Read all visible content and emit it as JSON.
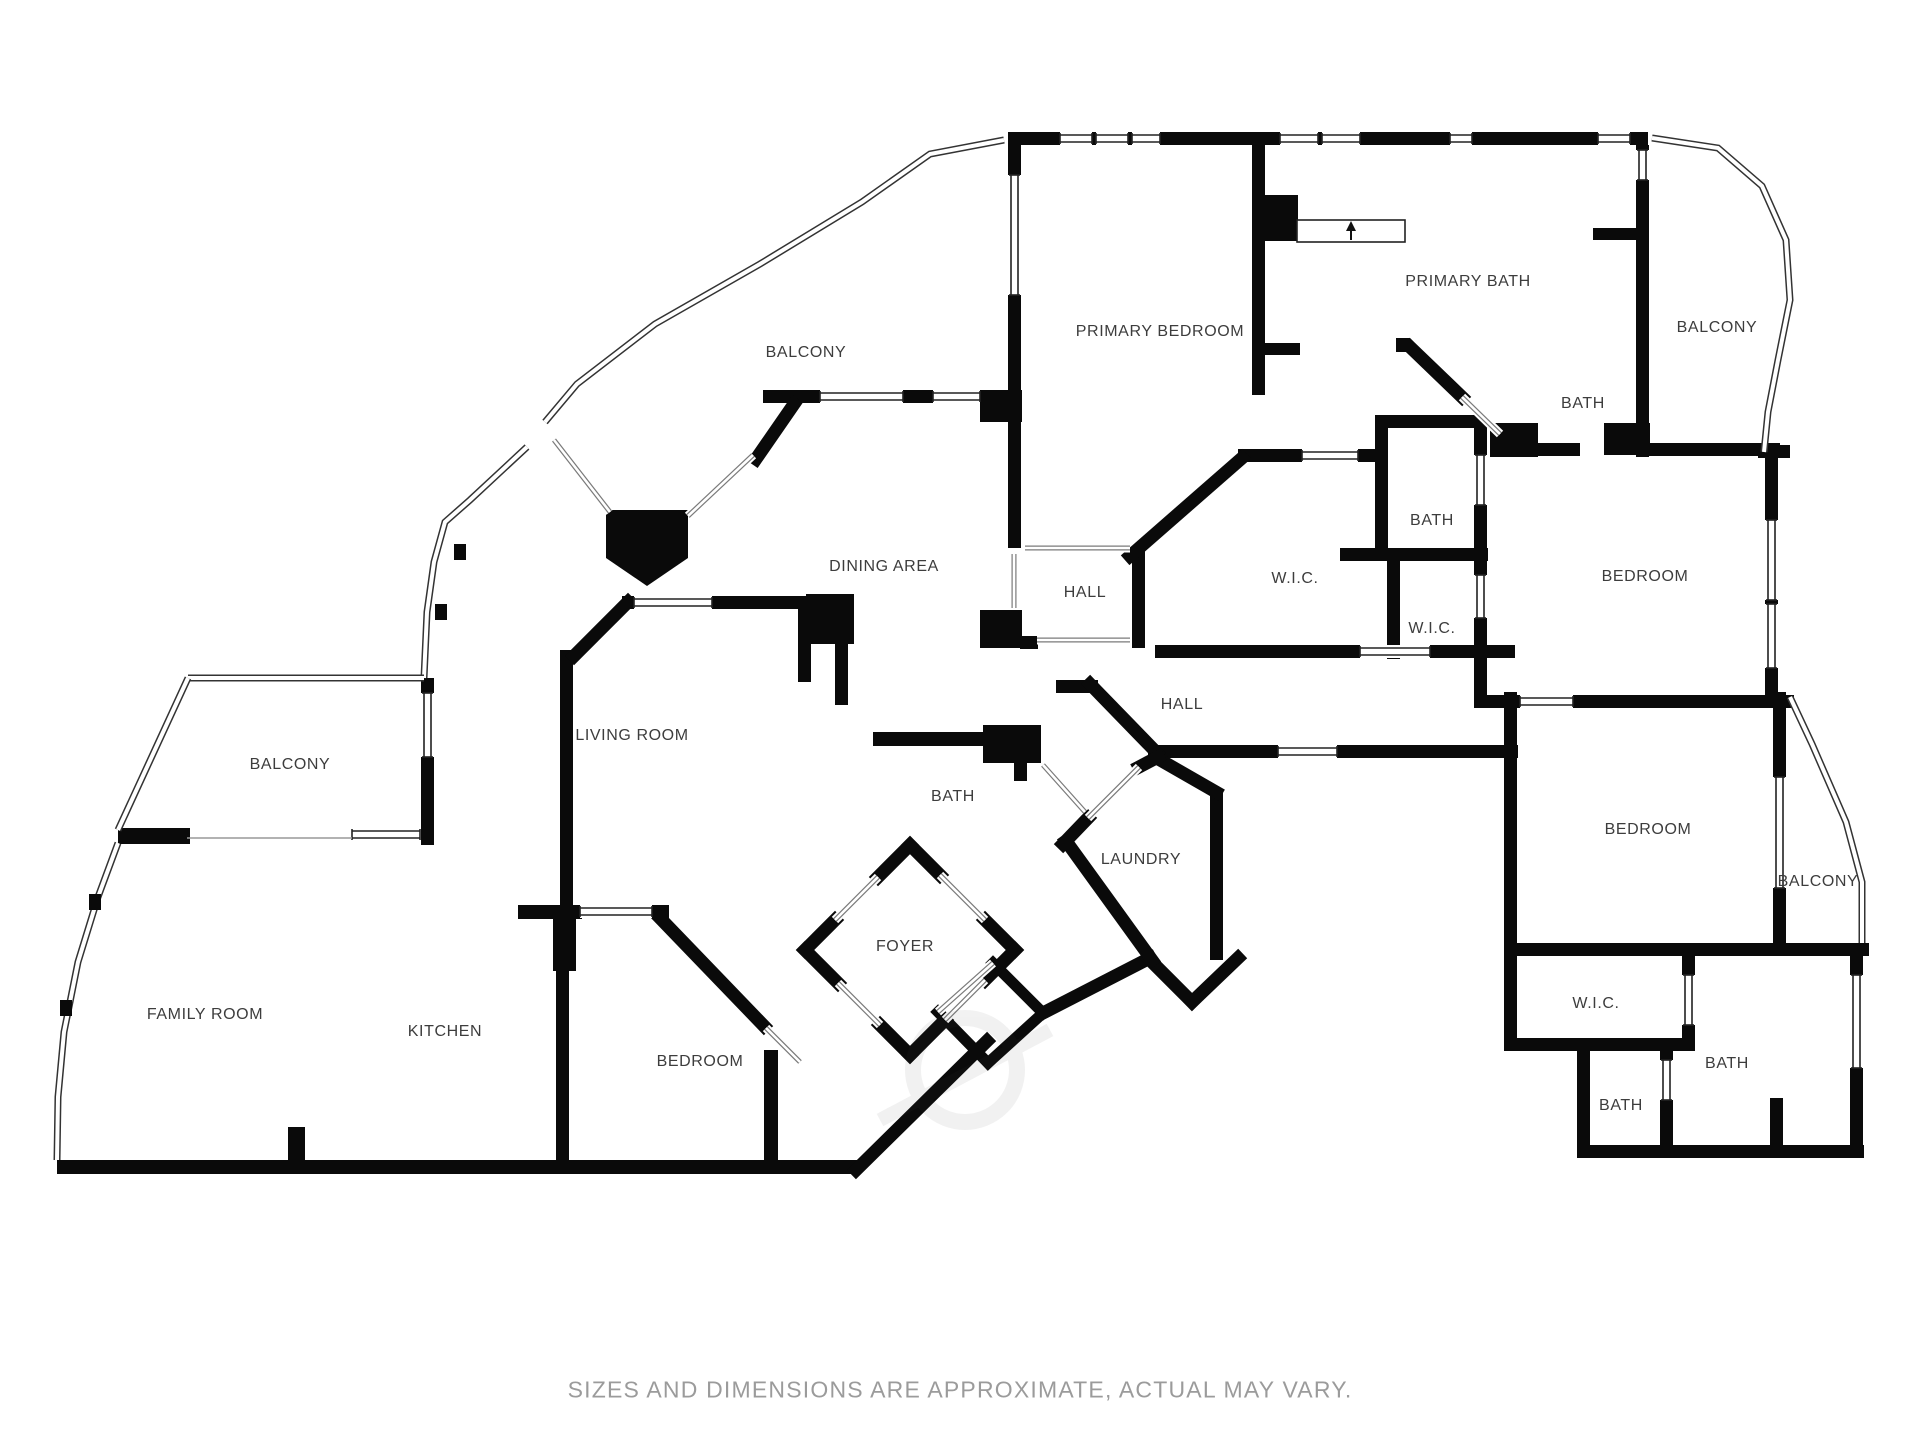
{
  "plan": {
    "wall_color": "#0a0a0a",
    "label_color": "#3d3d3d",
    "rooms": [
      {
        "slug": "balcony-top",
        "label": "BALCONY",
        "x": 806,
        "y": 353
      },
      {
        "slug": "primary-bedroom",
        "label": "PRIMARY BEDROOM",
        "x": 1160,
        "y": 332
      },
      {
        "slug": "primary-bath",
        "label": "PRIMARY BATH",
        "x": 1468,
        "y": 282
      },
      {
        "slug": "balcony-top-right",
        "label": "BALCONY",
        "x": 1717,
        "y": 328
      },
      {
        "slug": "bath-top-right",
        "label": "BATH",
        "x": 1583,
        "y": 404
      },
      {
        "slug": "bath-mid",
        "label": "BATH",
        "x": 1432,
        "y": 521
      },
      {
        "slug": "wic-main",
        "label": "W.I.C.",
        "x": 1295,
        "y": 579
      },
      {
        "slug": "wic-small",
        "label": "W.I.C.",
        "x": 1432,
        "y": 629
      },
      {
        "slug": "bedroom-right",
        "label": "BEDROOM",
        "x": 1645,
        "y": 577
      },
      {
        "slug": "hall-upper",
        "label": "HALL",
        "x": 1085,
        "y": 593
      },
      {
        "slug": "dining-area",
        "label": "DINING AREA",
        "x": 884,
        "y": 567
      },
      {
        "slug": "hall-lower",
        "label": "HALL",
        "x": 1182,
        "y": 705
      },
      {
        "slug": "living-room",
        "label": "LIVING ROOM",
        "x": 632,
        "y": 736
      },
      {
        "slug": "balcony-left",
        "label": "BALCONY",
        "x": 290,
        "y": 765
      },
      {
        "slug": "bath-center",
        "label": "BATH",
        "x": 953,
        "y": 797
      },
      {
        "slug": "laundry",
        "label": "LAUNDRY",
        "x": 1141,
        "y": 860
      },
      {
        "slug": "bedroom-lower-right",
        "label": "BEDROOM",
        "x": 1648,
        "y": 830
      },
      {
        "slug": "balcony-lower-right",
        "label": "BALCONY",
        "x": 1818,
        "y": 882
      },
      {
        "slug": "foyer",
        "label": "FOYER",
        "x": 905,
        "y": 947
      },
      {
        "slug": "family-room",
        "label": "FAMILY ROOM",
        "x": 205,
        "y": 1015
      },
      {
        "slug": "kitchen",
        "label": "KITCHEN",
        "x": 445,
        "y": 1032
      },
      {
        "slug": "bedroom-bottom",
        "label": "BEDROOM",
        "x": 700,
        "y": 1062
      },
      {
        "slug": "wic-bottom-right",
        "label": "W.I.C.",
        "x": 1596,
        "y": 1004
      },
      {
        "slug": "bath-bottom-right",
        "label": "BATH",
        "x": 1727,
        "y": 1064
      },
      {
        "slug": "bath-bottom-small",
        "label": "BATH",
        "x": 1621,
        "y": 1106
      }
    ]
  },
  "footer": {
    "text": "SIZES AND DIMENSIONS ARE APPROXIMATE, ACTUAL MAY VARY.",
    "color": "#9b9b9b"
  }
}
